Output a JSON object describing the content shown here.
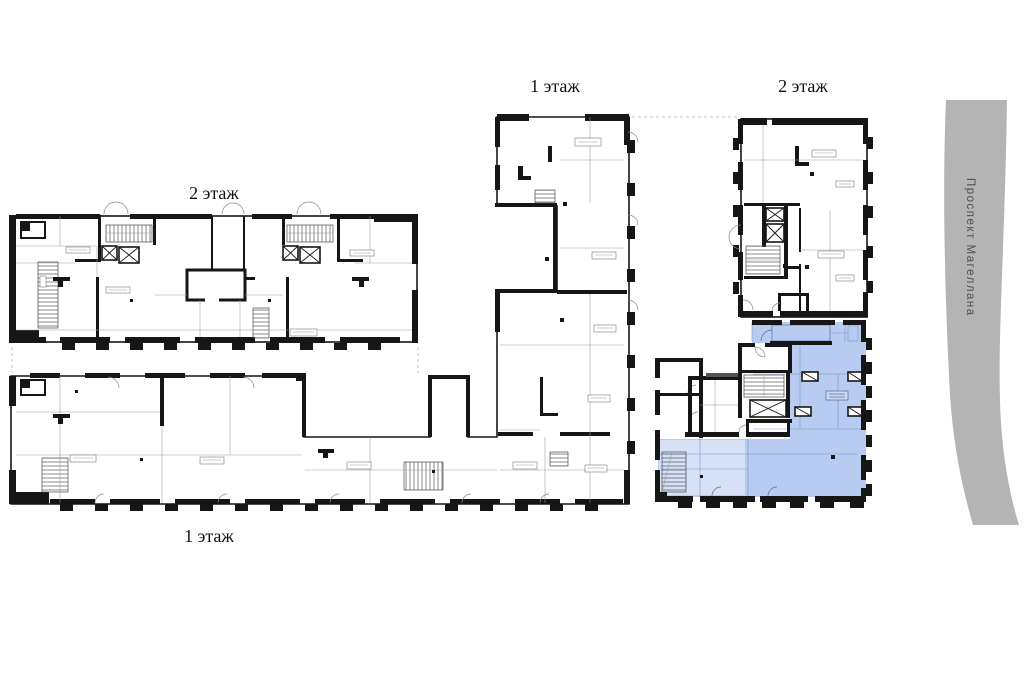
{
  "canvas": {
    "width": 1030,
    "height": 677,
    "background": "#ffffff"
  },
  "floor_labels": {
    "top_middle": "1 этаж",
    "top_right": "2 этаж",
    "left": "2 этаж",
    "bottom_left": "1 этаж"
  },
  "street": {
    "name": "Проспект Магеллана",
    "band_color": "#b4b4b4",
    "text_color": "#4f4f4f"
  },
  "highlight": {
    "fill": "#b7ccf0",
    "fill_light": "#d6e1f7",
    "line_color": "#7b95c9"
  },
  "drawing": {
    "wall_color": "#161616",
    "thin_line_color": "#9a9a9a",
    "dash_color": "#c4c4c4"
  }
}
